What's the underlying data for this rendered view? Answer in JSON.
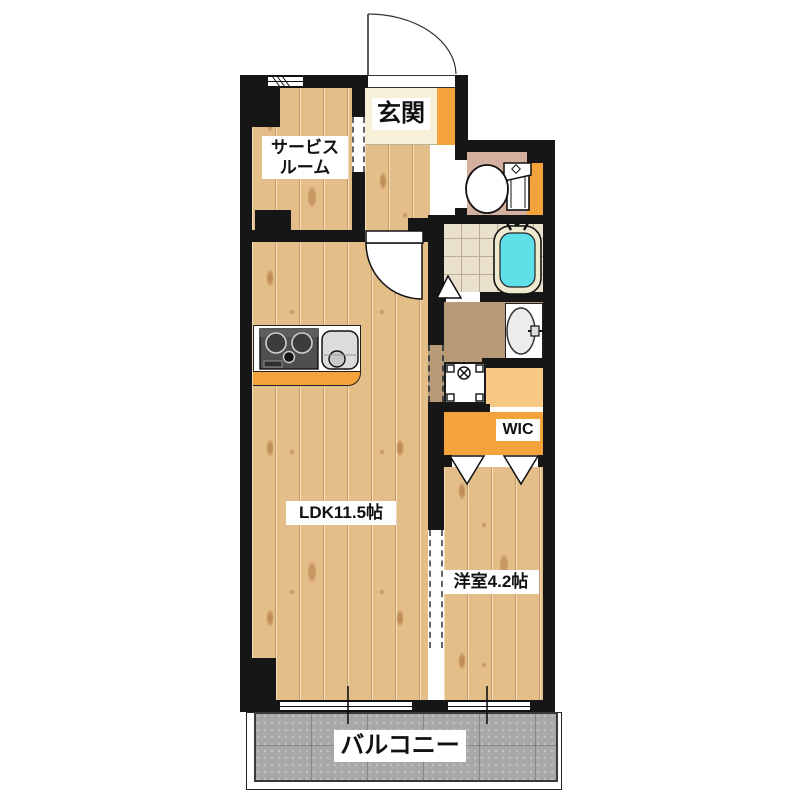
{
  "floorplan": {
    "rooms": {
      "service_room": {
        "label_line1": "サービス",
        "label_line2": "ルーム"
      },
      "entrance": {
        "label": "玄関"
      },
      "ldk": {
        "label": "LDK11.5帖"
      },
      "western_room": {
        "label": "洋室4.2帖"
      },
      "wic": {
        "label": "WIC"
      },
      "balcony": {
        "label": "バルコニー"
      }
    },
    "colors": {
      "wall": "#161616",
      "wood_floor": "#e4be88",
      "accent_orange": "#f3a33a",
      "light_orange": "#f8c885",
      "bathtub_cyan": "#5fdfe8",
      "bath_tile": "#e9e1cb",
      "washroom_brown": "#b79b79",
      "toilet_floor": "#d4b19e",
      "entrance_floor": "#f6f0d8",
      "balcony_gray": "#a8a8a8"
    },
    "fixtures": [
      "entrance-door",
      "interior-door",
      "toilet",
      "bathtub",
      "washbasin",
      "washing-machine-pan",
      "stove",
      "kitchen-sink",
      "folding-door",
      "sliding-door",
      "window"
    ]
  }
}
